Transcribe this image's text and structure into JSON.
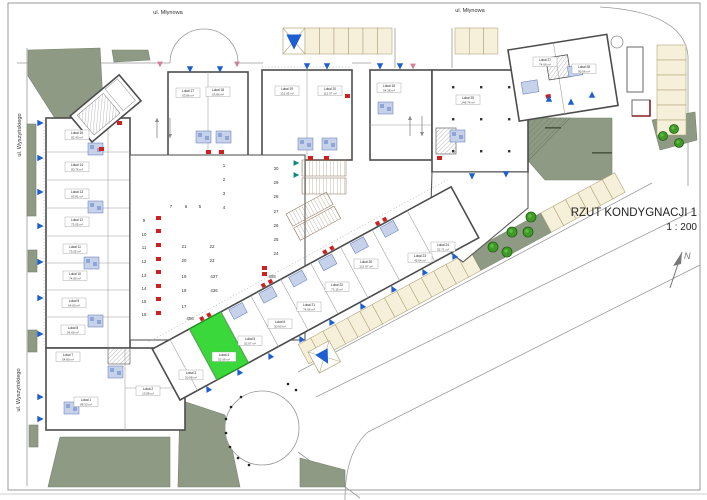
{
  "page": {
    "title_line1": "RZUT KONDYGNACJI 1",
    "title_line2": "1 : 200",
    "north": "N"
  },
  "streets": {
    "mlynowa": "ul. Młynowa",
    "wyszynskiego": "ul. Wyszyńskiego"
  },
  "highlight": {
    "name": "Lokal 4",
    "area": "52.06 m²",
    "color": "#3bd83b"
  },
  "colors": {
    "sage": "#8e9a83",
    "beige": "#f6f0da",
    "beige_stroke": "#b3a67c",
    "wall": "#4c4c4c",
    "blue": "#1d5fd0",
    "bath_fill": "#c6d1ea",
    "bath_stroke": "#5a74b4",
    "red": "#cf1f1f",
    "pink": "#d27d9b",
    "teal": "#0e8a7d",
    "green": "#3bd83b",
    "green_stroke": "#129312",
    "tree_fill": "#3f9b28",
    "tree_stroke": "#255f14",
    "text": "#3a3a3a"
  },
  "units": [
    [
      "Lokal 15",
      "82.40 m²",
      77,
      135
    ],
    [
      "Lokal 14",
      "80.76 m²",
      77,
      167
    ],
    [
      "Lokal 13",
      "65.81 m²",
      77,
      194
    ],
    [
      "Lokal 12",
      "73.05 m²",
      77,
      222
    ],
    [
      "Lokal 11",
      "73.05 m²",
      75,
      249
    ],
    [
      "Lokal 10",
      "74.80 m²",
      75,
      276
    ],
    [
      "Lokal 9",
      "54.60 m²",
      74,
      303
    ],
    [
      "Lokal 8",
      "54.60 m²",
      73,
      330
    ],
    [
      "Lokal 7",
      "54.80 m²",
      68,
      357
    ],
    [
      "Lokal 1",
      "88.33 m²",
      86,
      402
    ],
    [
      "Lokal 2",
      "13.88 m²",
      148,
      391
    ],
    [
      "Lokal 3",
      "50.08 m²",
      191,
      375
    ],
    [
      "Lokal 4",
      "52.06 m²",
      224,
      357
    ],
    [
      "Lokal 5",
      "52.07 m²",
      250,
      341
    ],
    [
      "Lokal 6",
      "50.93 m²",
      280,
      324
    ],
    [
      "Lokal 21",
      "74.06 m²",
      309,
      307
    ],
    [
      "Lokal 22",
      "73.16 m²",
      337,
      287
    ],
    [
      "Lokal 26",
      "121.97 m²",
      366,
      264
    ],
    [
      "Lokal 23",
      "45.64 m²",
      420,
      258
    ],
    [
      "Lokal 24",
      "52.71 m²",
      443,
      247
    ],
    [
      "Lokal 17",
      "53.86 m²",
      188,
      93
    ],
    [
      "Lokal 18",
      "53.86 m²",
      218,
      92
    ],
    [
      "Lokal 19",
      "131.05 m²",
      287,
      91
    ],
    [
      "Lokal 20",
      "112.37 m²",
      330,
      91
    ],
    [
      "Lokal 16",
      "54.38 m²",
      389,
      88
    ],
    [
      "Lokal 25",
      "248.74 m²",
      468,
      100
    ],
    [
      "Lokal 27",
      "74.06 m²",
      545,
      62
    ],
    [
      "Lokal 28",
      "80.56 m²",
      584,
      69
    ]
  ],
  "garage_numbers": [
    [
      "1",
      224,
      167
    ],
    [
      "2",
      224,
      181
    ],
    [
      "3",
      224,
      195
    ],
    [
      "4",
      224,
      209
    ],
    [
      "7",
      171,
      208
    ],
    [
      "6",
      186,
      208
    ],
    [
      "5",
      200,
      208
    ],
    [
      "9",
      144,
      222
    ],
    [
      "10",
      144,
      236
    ],
    [
      "11",
      144,
      249
    ],
    [
      "12",
      144,
      263
    ],
    [
      "13",
      144,
      277
    ],
    [
      "14",
      144,
      290
    ],
    [
      "15",
      144,
      303
    ],
    [
      "16",
      144,
      316
    ],
    [
      "30",
      276,
      170
    ],
    [
      "29",
      276,
      184
    ],
    [
      "28",
      276,
      198
    ],
    [
      "27",
      276,
      213
    ],
    [
      "26",
      276,
      227
    ],
    [
      "25",
      276,
      241
    ],
    [
      "24",
      276,
      255
    ],
    [
      "21",
      184,
      248
    ],
    [
      "22",
      212,
      248
    ],
    [
      "20",
      184,
      262
    ],
    [
      "23",
      212,
      262
    ],
    [
      "19",
      184,
      278
    ],
    [
      "437",
      214,
      278
    ],
    [
      "18",
      184,
      292
    ],
    [
      "436",
      214,
      292
    ],
    [
      "17",
      184,
      308
    ],
    [
      "406",
      190,
      320
    ],
    [
      "408",
      272,
      278
    ]
  ],
  "blue_triangles": [
    [
      190,
      69,
      0,
      1
    ],
    [
      220,
      69,
      0,
      1
    ],
    [
      307,
      66,
      0,
      1
    ],
    [
      327,
      66,
      0,
      1
    ],
    [
      380,
      66,
      0,
      1
    ],
    [
      400,
      66,
      0,
      1
    ],
    [
      472,
      176,
      0,
      1
    ],
    [
      506,
      174,
      0,
      1
    ],
    [
      549,
      99,
      180,
      1
    ],
    [
      571,
      102,
      180,
      1
    ],
    [
      592,
      95,
      180,
      1
    ],
    [
      40,
      123,
      270,
      1
    ],
    [
      40,
      158,
      270,
      1
    ],
    [
      40,
      192,
      270,
      1
    ],
    [
      40,
      226,
      270,
      1
    ],
    [
      40,
      262,
      270,
      1
    ],
    [
      40,
      298,
      270,
      1
    ],
    [
      40,
      334,
      270,
      1
    ],
    [
      40,
      397,
      270,
      1
    ],
    [
      40,
      419,
      270,
      1
    ],
    [
      208,
      389,
      152,
      1
    ],
    [
      239,
      372,
      152,
      1
    ],
    [
      270,
      356,
      152,
      1
    ],
    [
      301,
      339,
      152,
      1
    ],
    [
      331,
      322,
      152,
      1
    ],
    [
      362,
      306,
      152,
      1
    ],
    [
      393,
      289,
      152,
      1
    ],
    [
      424,
      272,
      152,
      1
    ],
    [
      454,
      256,
      152,
      1
    ]
  ],
  "pink_triangles": [
    [
      160,
      64
    ],
    [
      237,
      64
    ],
    [
      413,
      66
    ]
  ],
  "teal_triangles": [
    [
      296,
      163
    ],
    [
      296,
      175
    ]
  ],
  "red_marks": [
    [
      156,
      216
    ],
    [
      156,
      229
    ],
    [
      156,
      243
    ],
    [
      156,
      257
    ],
    [
      156,
      270
    ],
    [
      156,
      284
    ],
    [
      156,
      297
    ],
    [
      156,
      311
    ],
    [
      206,
      150
    ],
    [
      219,
      150
    ],
    [
      308,
      156
    ],
    [
      324,
      156
    ],
    [
      99,
      147
    ],
    [
      117,
      121
    ],
    [
      262,
      266
    ],
    [
      262,
      272
    ],
    [
      345,
      94
    ],
    [
      437,
      156
    ]
  ],
  "bath_cores": [
    [
      88,
      143
    ],
    [
      88,
      201
    ],
    [
      84,
      257
    ],
    [
      88,
      315
    ],
    [
      64,
      402
    ],
    [
      108,
      366
    ],
    [
      196,
      131
    ],
    [
      216,
      131
    ],
    [
      298,
      138
    ],
    [
      322,
      138
    ],
    [
      378,
      102
    ],
    [
      450,
      130
    ]
  ],
  "trees": [
    [
      493,
      247,
      5
    ],
    [
      507,
      252,
      5
    ],
    [
      512,
      232,
      5
    ],
    [
      528,
      232,
      5
    ],
    [
      531,
      217,
      5
    ],
    [
      663,
      136,
      4.5
    ],
    [
      674,
      129,
      4.5
    ],
    [
      679,
      143,
      4.5
    ]
  ],
  "dots": [
    [
      241,
      397
    ],
    [
      231,
      407
    ],
    [
      226,
      419
    ],
    [
      226,
      433
    ],
    [
      230,
      447
    ],
    [
      238,
      458
    ],
    [
      249,
      465
    ],
    [
      288,
      384
    ],
    [
      296,
      390
    ]
  ],
  "columns": [
    [
      452,
      86
    ],
    [
      480,
      86
    ],
    [
      508,
      86
    ],
    [
      452,
      118
    ],
    [
      480,
      118
    ],
    [
      508,
      118
    ],
    [
      452,
      150
    ],
    [
      480,
      150
    ],
    [
      508,
      150
    ]
  ],
  "ramp_arrows": [
    [
      157,
      138,
      157,
      118
    ],
    [
      170,
      118,
      170,
      138
    ],
    [
      410,
      136,
      410,
      116
    ],
    [
      422,
      116,
      422,
      136
    ]
  ]
}
